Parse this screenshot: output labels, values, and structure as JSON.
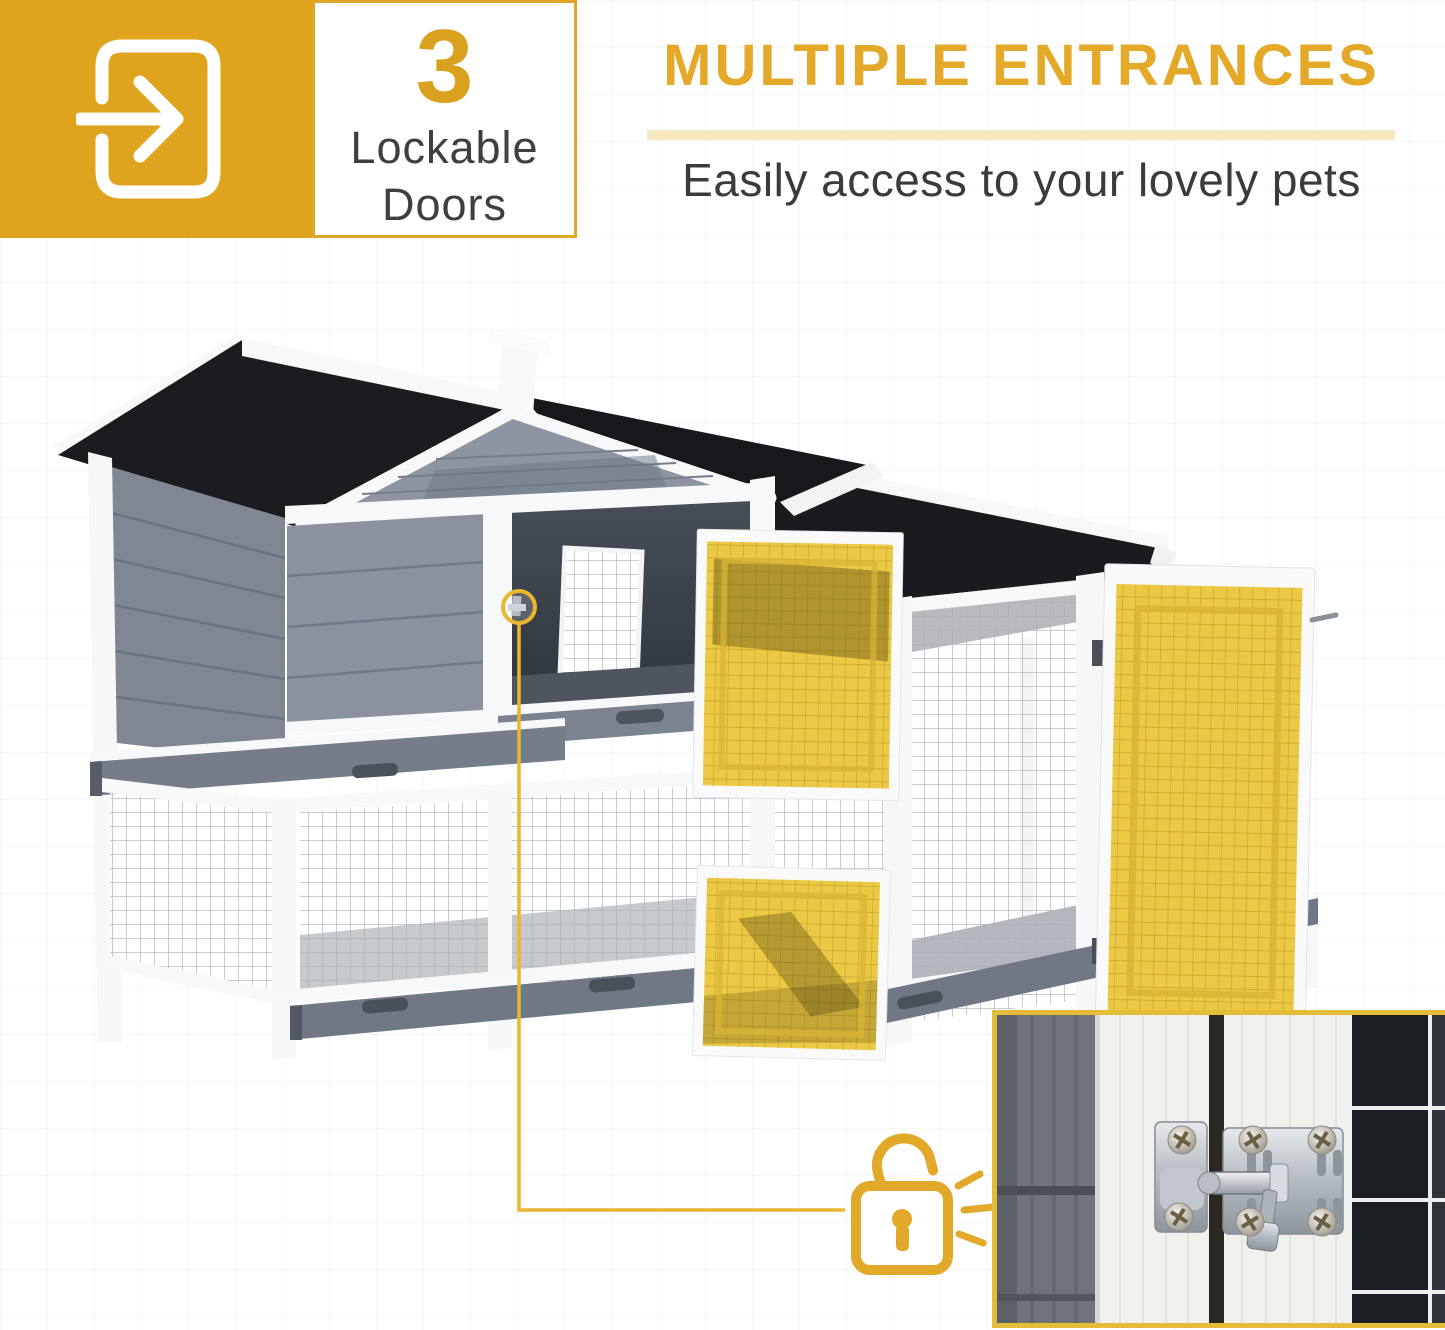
{
  "badge": {
    "icon": "enter-arrow-icon",
    "count": "3",
    "label_line1": "Lockable",
    "label_line2": "Doors"
  },
  "header": {
    "title": "MULTIPLE ENTRANCES",
    "subtitle": "Easily access to your lovely pets"
  },
  "callout": {
    "icon": "padlock-unlocked-icon",
    "target": "door-latch-highlight"
  },
  "inset": {
    "icon": "slide-bolt-latch-photo"
  },
  "colors": {
    "gold": "#E2A82A",
    "badge_gold": "#DFA31E",
    "title_gold": "#E4A928",
    "divider_cream": "#F6E8C0",
    "text_dark": "#3B3B3E",
    "door_highlight_yellow": "#ECC945",
    "roof_black": "#1A1B1E",
    "wood_gray": "#858E9B",
    "tray_gray": "#6F7884",
    "trim_white": "#F7F8F9"
  }
}
